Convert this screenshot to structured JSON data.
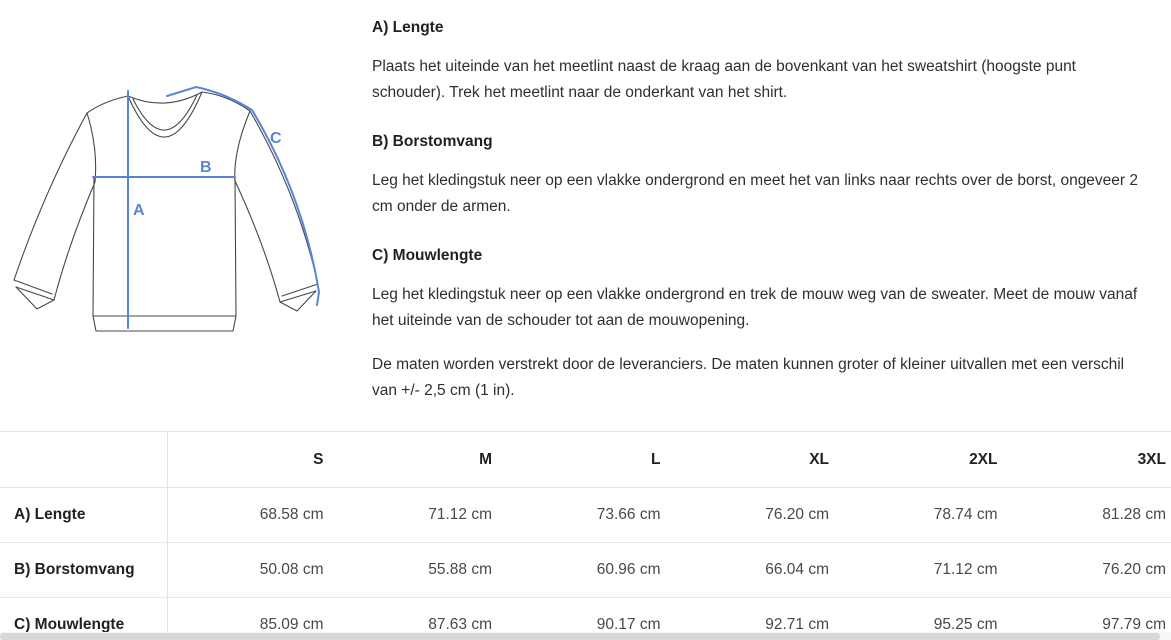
{
  "instructions": {
    "sections": [
      {
        "heading": "A) Lengte",
        "body": "Plaats het uiteinde van het meetlint naast de kraag aan de bovenkant van het sweatshirt (hoogste punt schouder). Trek het meetlint naar de onderkant van het shirt."
      },
      {
        "heading": "B) Borstomvang",
        "body": "Leg het kledingstuk neer op een vlakke ondergrond en meet het van links naar rechts over de borst, ongeveer 2 cm onder de armen."
      },
      {
        "heading": "C) Mouwlengte",
        "body": "Leg het kledingstuk neer op een vlakke ondergrond en trek de mouw weg van de sweater. Meet de mouw vanaf het uiteinde van de schouder tot aan de mouwopening."
      }
    ],
    "disclaimer": "De maten worden verstrekt door de leveranciers. De maten kunnen groter of kleiner uitvallen met een verschil van +/- 2,5 cm (1 in)."
  },
  "diagram": {
    "labels": {
      "a": "A",
      "b": "B",
      "c": "C"
    },
    "line_color": "#5b84d6",
    "outline_color": "#474747"
  },
  "size_table": {
    "columns": [
      "S",
      "M",
      "L",
      "XL",
      "2XL",
      "3XL"
    ],
    "rows": [
      {
        "label": "A) Lengte",
        "values": [
          "68.58 cm",
          "71.12 cm",
          "73.66 cm",
          "76.20 cm",
          "78.74 cm",
          "81.28 cm"
        ]
      },
      {
        "label": "B) Borstomvang",
        "values": [
          "50.08 cm",
          "55.88 cm",
          "60.96 cm",
          "66.04 cm",
          "71.12 cm",
          "76.20 cm"
        ]
      },
      {
        "label": "C) Mouwlengte",
        "values": [
          "85.09 cm",
          "87.63 cm",
          "90.17 cm",
          "92.71 cm",
          "95.25 cm",
          "97.79 cm"
        ]
      }
    ]
  }
}
